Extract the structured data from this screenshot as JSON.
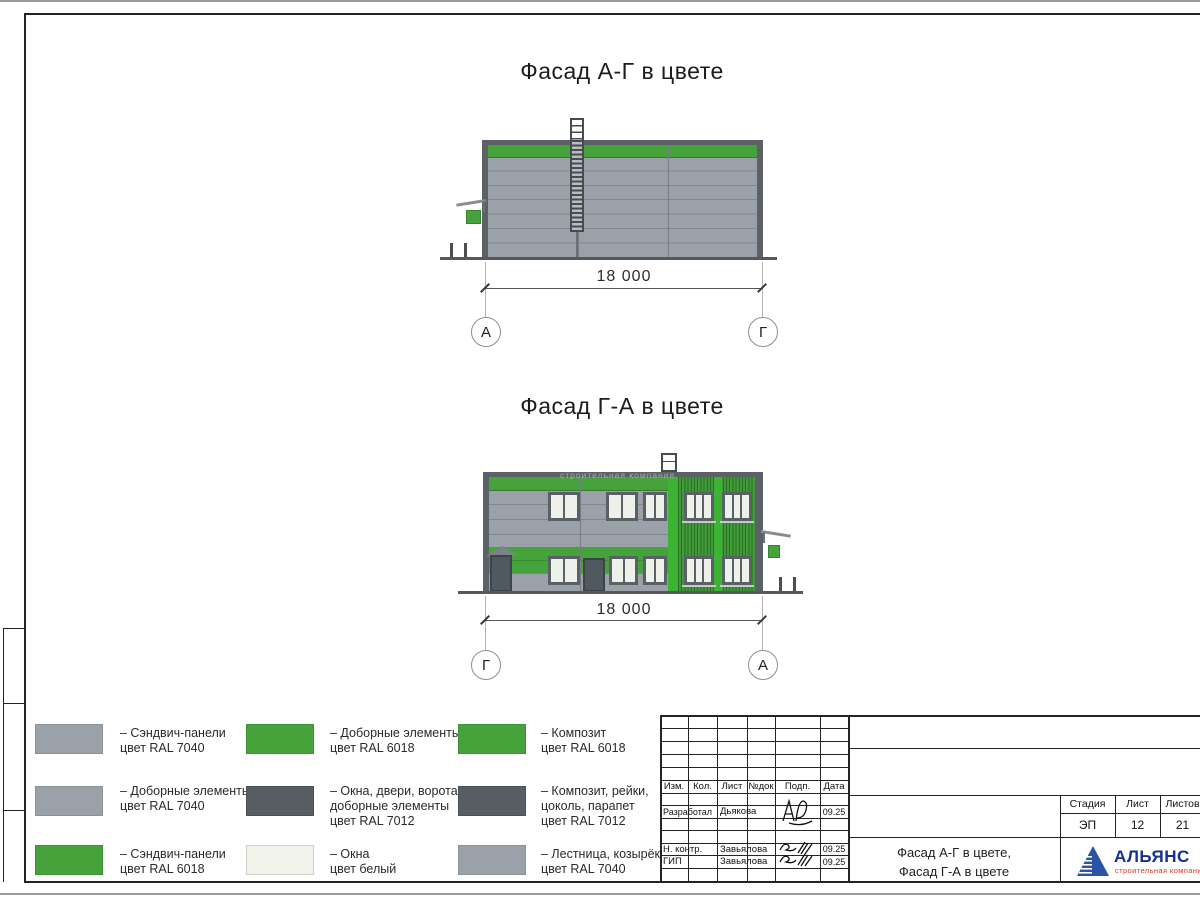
{
  "sheet": {
    "facade1": {
      "title": "Фасад А-Г в цвете",
      "dimension": "18 000",
      "axis_left": "А",
      "axis_right": "Г"
    },
    "facade2": {
      "title": "Фасад Г-А в цвете",
      "dimension": "18 000",
      "axis_left": "Г",
      "axis_right": "А",
      "watermark": "строительная компания"
    }
  },
  "legend": {
    "items": [
      {
        "color": "#9aa1a8",
        "lines": [
          "– Сэндвич-панели",
          "цвет RAL 7040"
        ]
      },
      {
        "color": "#9aa1a8",
        "lines": [
          "– Доборные элементы",
          "цвет RAL 7040"
        ]
      },
      {
        "color": "#46a33c",
        "lines": [
          "– Сэндвич-панели",
          "цвет RAL 6018"
        ]
      },
      {
        "color": "#46a33c",
        "lines": [
          "– Доборные элементы",
          "цвет RAL 6018"
        ]
      },
      {
        "color": "#575f64",
        "lines": [
          "– Окна, двери, ворота,",
          "доборные элементы",
          "цвет RAL 7012"
        ]
      },
      {
        "color": "#f2f4ec",
        "lines": [
          "– Окна",
          "цвет белый"
        ]
      },
      {
        "color": "#46a33c",
        "lines": [
          "– Композит",
          "цвет RAL 6018"
        ]
      },
      {
        "color": "#575f64",
        "lines": [
          "– Композит, рейки,",
          "цоколь, парапет",
          "цвет RAL 7012"
        ]
      },
      {
        "color": "#9aa1a8",
        "lines": [
          "– Лестница, козырёк",
          "цвет RAL 7040"
        ]
      }
    ]
  },
  "stamp": {
    "columns": [
      "Изм.",
      "Кол.",
      "Лист",
      "№док",
      "Подп.",
      "Дата"
    ],
    "rows": [
      {
        "role": "Разработал",
        "name": "Дьякова",
        "date": "09.25"
      },
      {
        "role": "Н. контр.",
        "name": "Завьялова",
        "date": "09.25"
      },
      {
        "role": "ГИП",
        "name": "Завьялова",
        "date": "09.25"
      }
    ],
    "doc_title_line1": "Фасад А-Г в цвете,",
    "doc_title_line2": "Фасад Г-А в цвете",
    "stage_label": "Стадия",
    "stage_value": "ЭП",
    "sheet_label": "Лист",
    "sheet_value": "12",
    "sheets_label": "Листов",
    "sheets_value": "21",
    "logo_name": "АЛЬЯНС",
    "logo_subtitle": "строительная компания"
  },
  "colors": {
    "panel_gray": "#9aa1a8",
    "joint_gray": "#81888d",
    "corner_dark": "#5b6166",
    "dark_gray_ral7012": "#575f64",
    "green_ral6018": "#46a33c",
    "bright_green": "#3db334",
    "batten_green": "#3f9b37",
    "window_white": "#eef1e9",
    "logo_blue": "#2b55a4",
    "logo_text_blue": "#16308f",
    "logo_red": "#d5382b"
  }
}
